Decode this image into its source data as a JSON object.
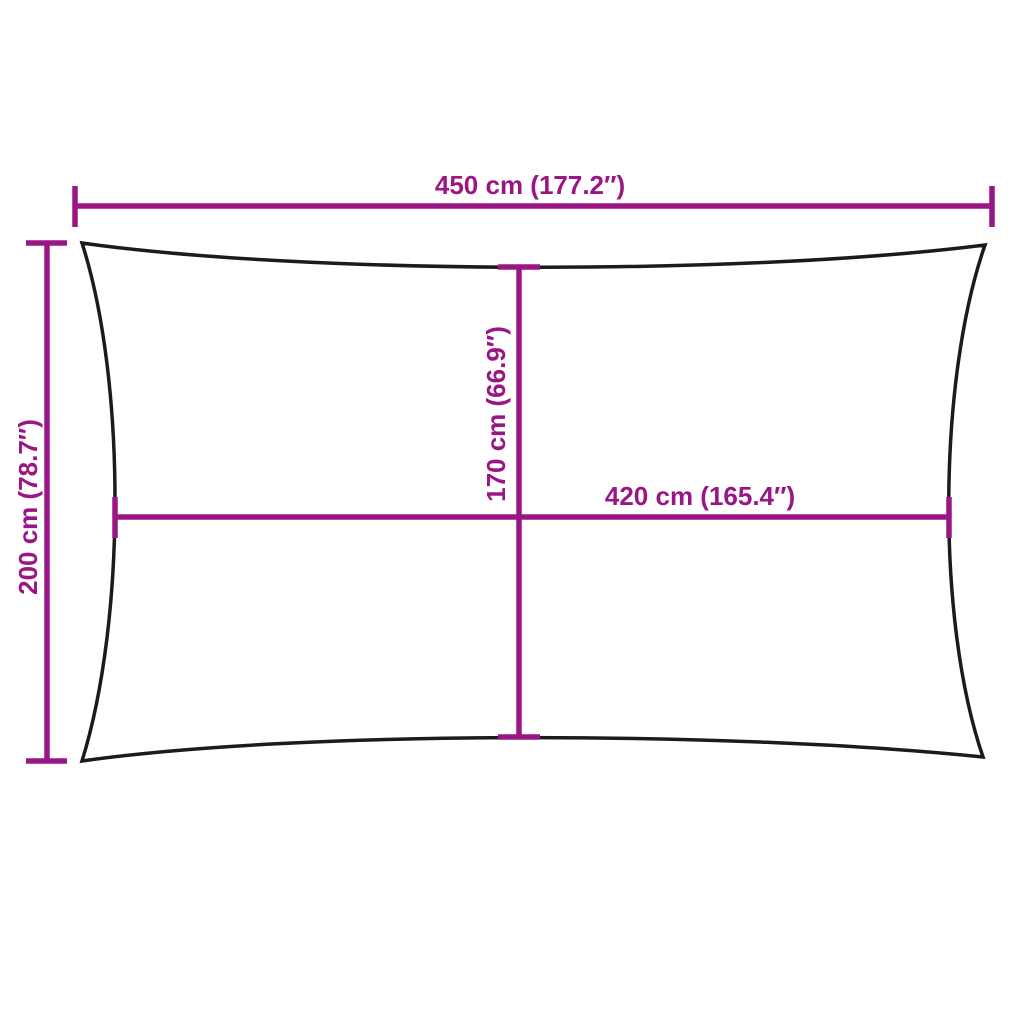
{
  "diagram": {
    "type": "product-dimension-diagram",
    "subject": "rectangular shade sail outline",
    "dimensions": {
      "width": {
        "label": "450 cm (177.2″)"
      },
      "height": {
        "label": "200 cm (78.7″)"
      },
      "inner_height": {
        "label": "170 cm (66.9″)"
      },
      "inner_width": {
        "label": "420 cm (165.4″)"
      }
    },
    "colors": {
      "dimension": "#9b1685",
      "outline": "#1b1b1b",
      "background": "#ffffff"
    }
  }
}
